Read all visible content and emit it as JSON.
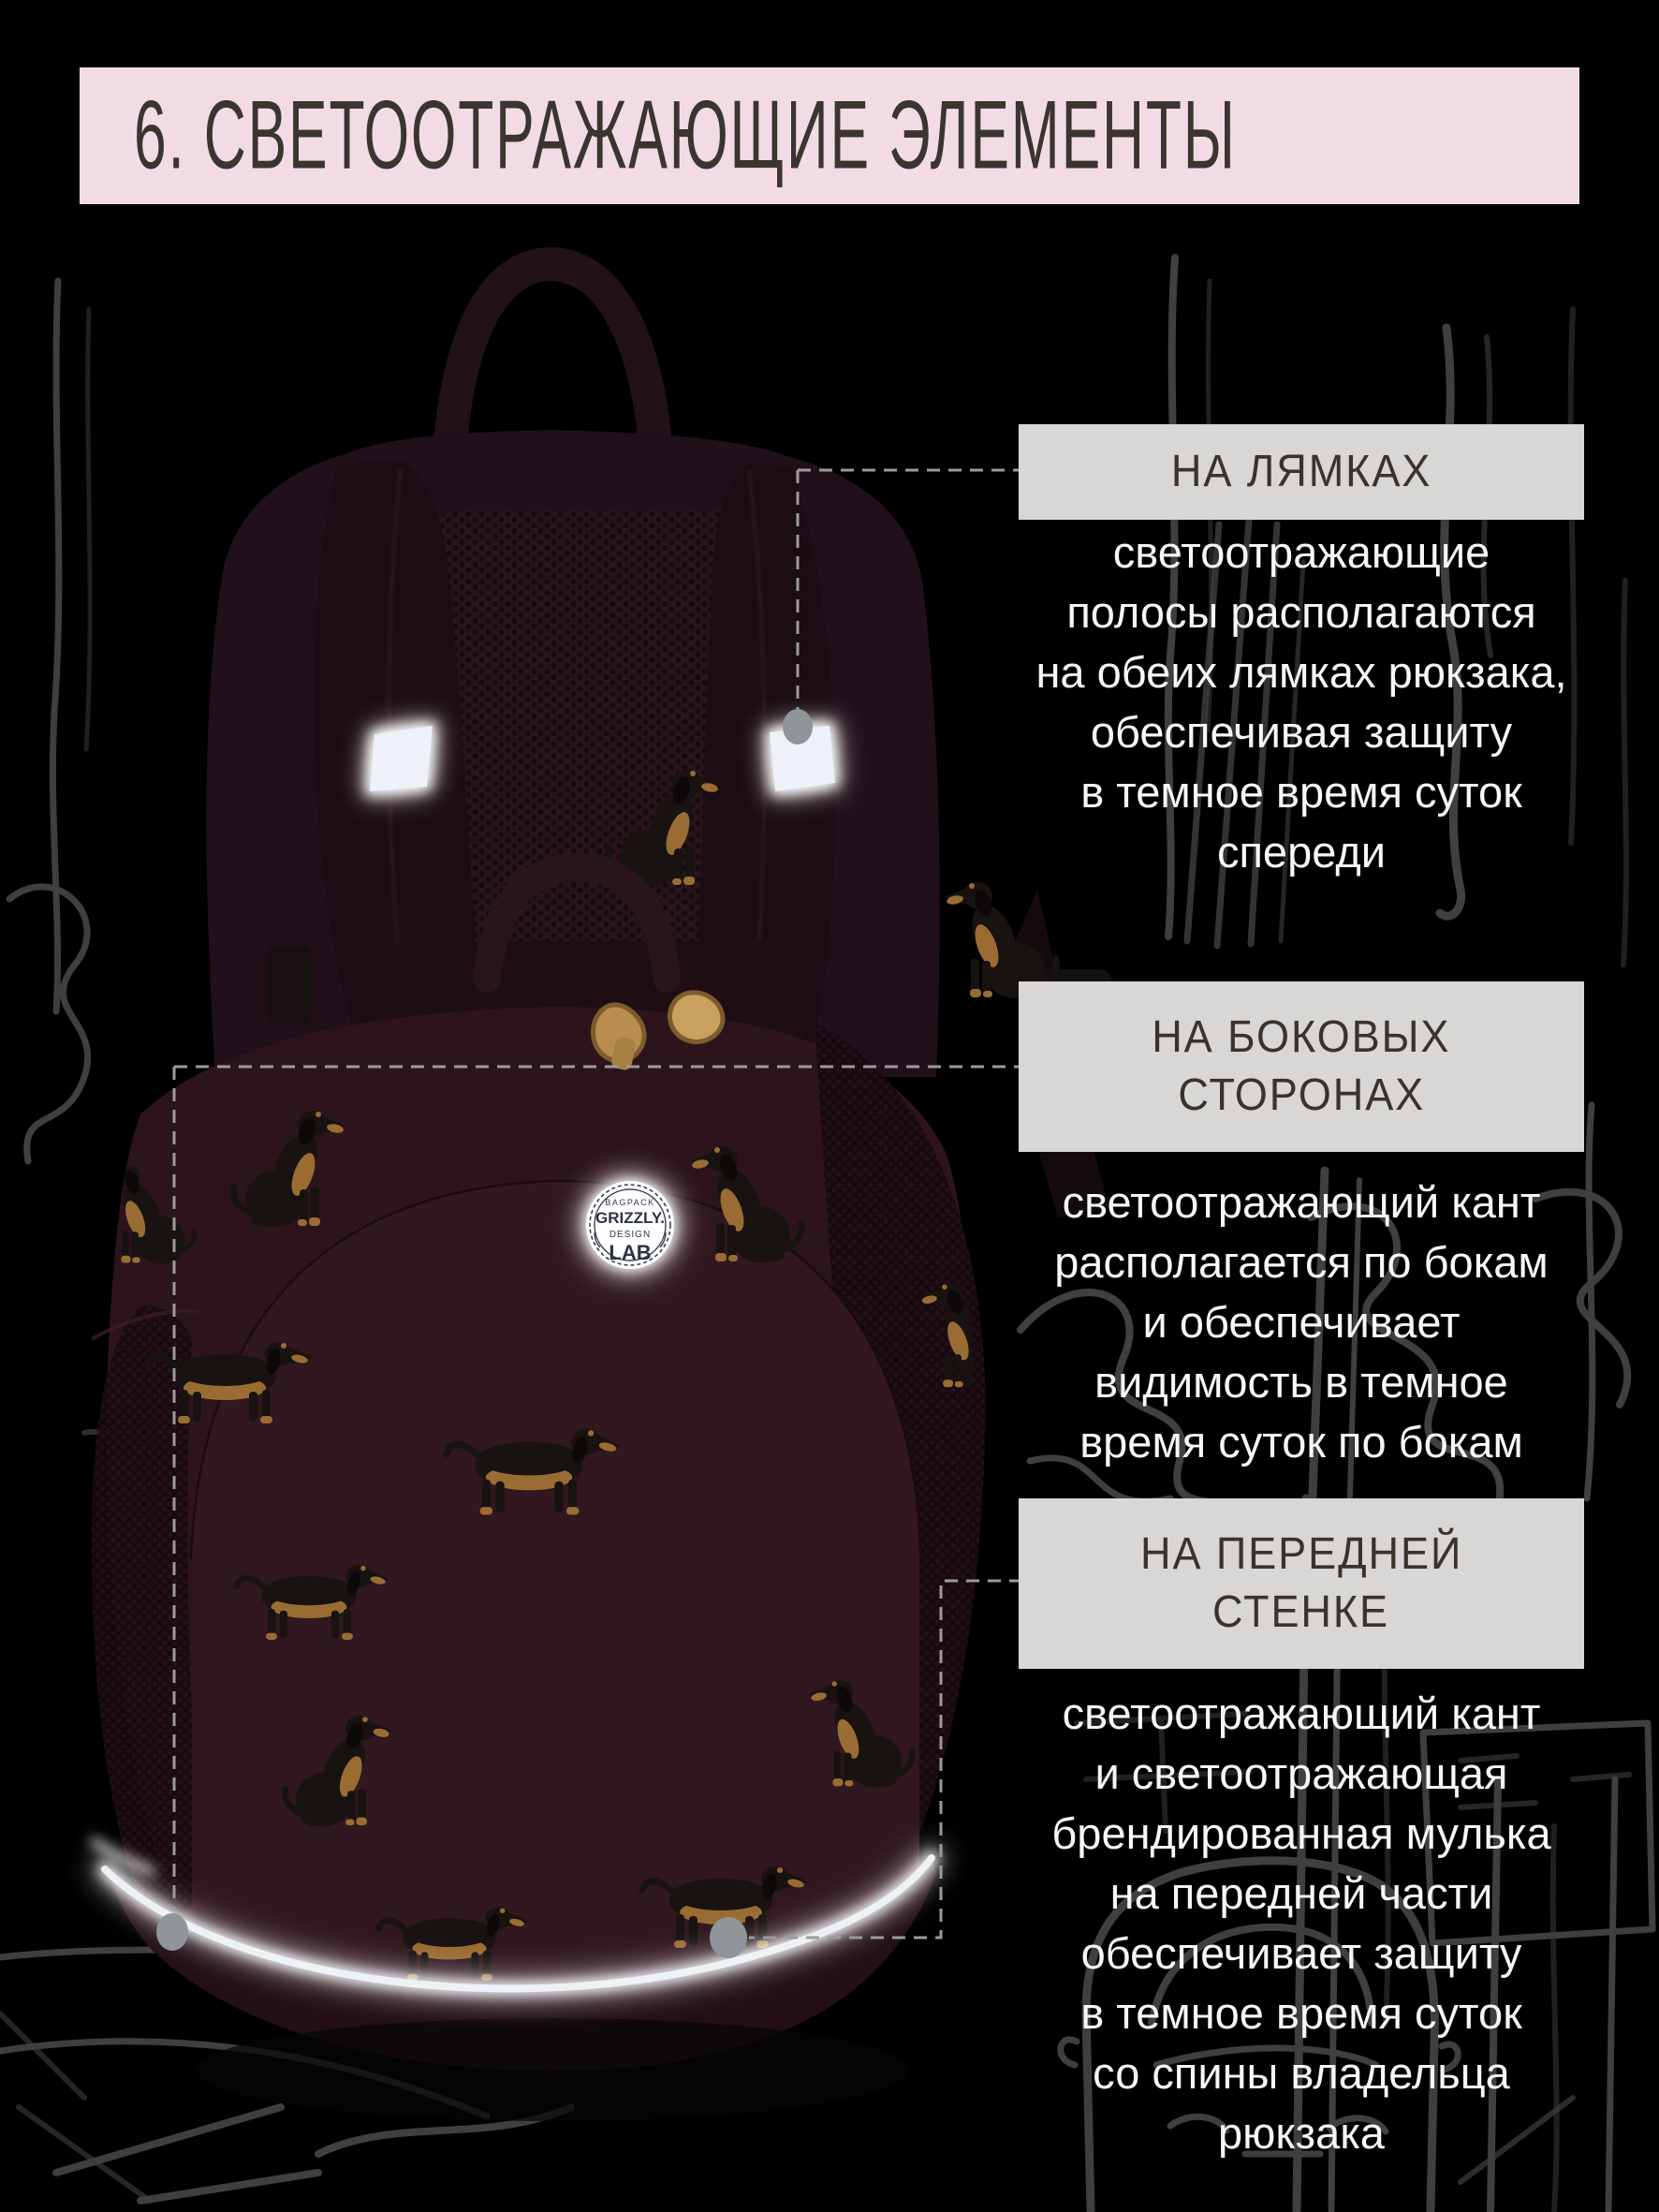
{
  "header": {
    "title": "6. СВЕТООТРАЖАЮЩИЕ ЭЛЕМЕНТЫ"
  },
  "sections": [
    {
      "label_lines": [
        "НА ЛЯМКАХ"
      ],
      "body_lines": [
        "светоотражающие",
        "полосы располагаются",
        "на обеих лямках рюкзака,",
        "обеспечивая защиту",
        "в темное время суток",
        "спереди"
      ]
    },
    {
      "label_lines": [
        "НА БОКОВЫХ",
        "СТОРОНАХ"
      ],
      "body_lines": [
        "светоотражающий кант",
        "располагается по бокам",
        "и обеспечивает",
        "видимость в темное",
        "время суток по бокам"
      ]
    },
    {
      "label_lines": [
        "НА ПЕРЕДНЕЙ",
        "СТЕНКЕ"
      ],
      "body_lines": [
        "светоотражающий кант",
        "и светоотражающая",
        "брендированная мулька",
        "на передней части",
        "обеспечивает защиту",
        "в темное время суток",
        "со спины владельца",
        "рюкзака"
      ]
    }
  ],
  "logo_badge": {
    "top": "BAGPACK",
    "brand": "GRIZZLY.",
    "mid": "DESIGN",
    "bottom": "LAB"
  },
  "icons": {
    "callout_dot": "gray-ellipse-marker",
    "reflective_patch": "glowing-white-square",
    "reflective_piping": "glowing-white-curve"
  },
  "colors": {
    "header_bar": "#f3dbe6",
    "title_text": "#3a352e",
    "label_bar": "#d8d7d5",
    "label_text": "#3a332b",
    "body_text": "#f7f7f7",
    "dash": "#9b9b9b",
    "dot": "#8f9598",
    "reflective": "#f2f4fa",
    "backpack_body": "#2d141c",
    "dog_tan": "#9a6c33"
  }
}
